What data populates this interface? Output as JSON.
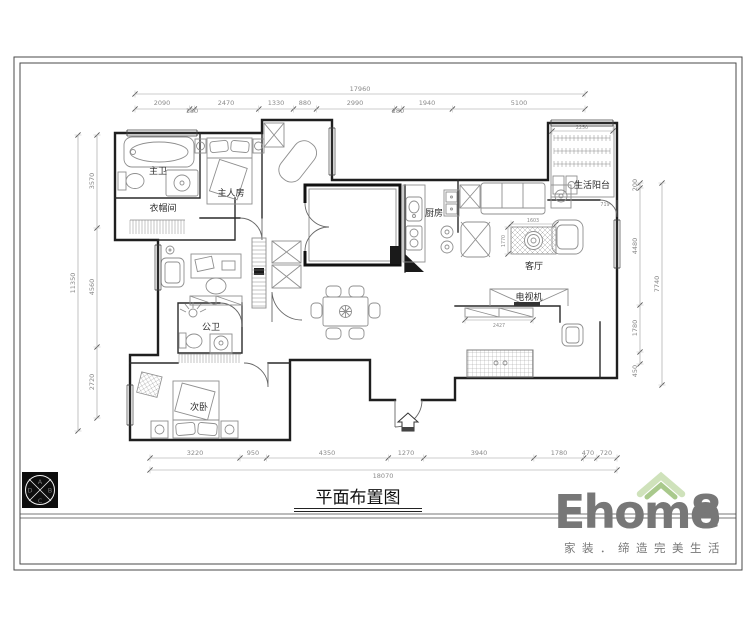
{
  "sheet": {
    "title": "平面布置图"
  },
  "rooms": {
    "master_bath": "主卫",
    "cloakroom": "衣帽间",
    "master_bedroom": "主人房",
    "kitchen": "厨房",
    "living_room": "客厅",
    "service_balcony": "生活阳台",
    "guest_bath": "公卫",
    "second_bedroom": "次卧",
    "tv_label": "电视机"
  },
  "dims": {
    "top": {
      "overall": "17960",
      "segments": [
        "2090",
        "180",
        "2470",
        "1330",
        "880",
        "2990",
        "280",
        "1940",
        "5100"
      ]
    },
    "bottom": {
      "overall": "18070",
      "segments": [
        "3220",
        "950",
        "4350",
        "1270",
        "3940",
        "1780",
        "470",
        "720"
      ]
    },
    "left": {
      "overall": "11350",
      "segments": [
        "3570",
        "4560",
        "2720"
      ]
    },
    "right": {
      "overall": "7740",
      "segments": [
        "200",
        "4480",
        "1780",
        "450"
      ]
    },
    "inner": {
      "balcony_width": "2250",
      "balcony_door": "719",
      "rug_width": "1603",
      "sofa_zone_depth": "1770",
      "tv_zone_width": "2100",
      "tv_cabinet_width": "2427"
    }
  },
  "compass": {
    "top": "A",
    "right": "B",
    "bottom": "C",
    "left": "D"
  },
  "logo": {
    "brand_main": "Ehome",
    "brand_8": "8",
    "tagline": "家装．缔造完美生活",
    "brand_color": "#f8d0a8",
    "accent_color": "#f3ad72",
    "roof_color": "#cfe2bb",
    "roof_inner_color": "#a9c98c",
    "tagline_color": "#bdd6a4"
  }
}
